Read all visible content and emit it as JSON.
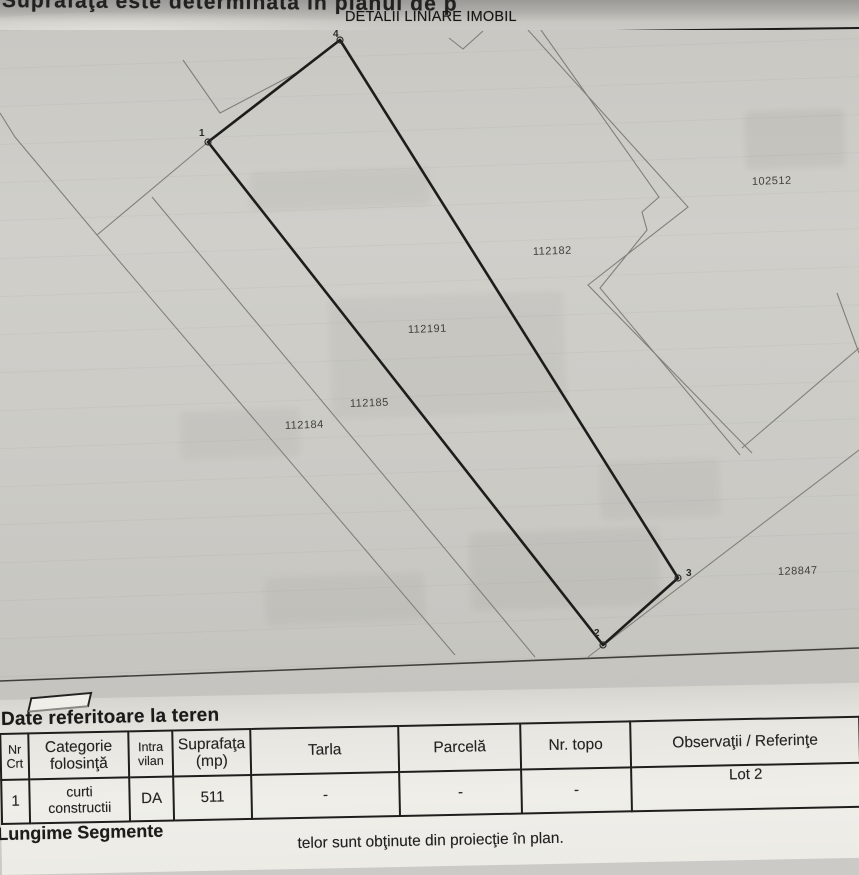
{
  "header": {
    "top_text": "Suprafaţa este determinată în planul de p",
    "band_title": "DETALII LINIARE IMOBIL"
  },
  "map": {
    "parcels": [
      "102512",
      "112182",
      "112191",
      "112185",
      "112184",
      "128847"
    ],
    "vertices": [
      "4",
      "1",
      "2",
      "3"
    ]
  },
  "table": {
    "section_title": "Date referitoare la teren",
    "columns": [
      "Nr\nCrt",
      "Categorie\nfolosinţă",
      "Intra\nvilan",
      "Suprafaţa\n(mp)",
      "Tarla",
      "Parcelă",
      "Nr. topo",
      "Observaţii / Referinţe"
    ],
    "rows": [
      [
        "1",
        "curti\nconstructii",
        "DA",
        "511",
        "-",
        "-",
        "-",
        "Lot 2"
      ]
    ]
  },
  "footer": {
    "title": "Lungime Segmente",
    "note": "telor sunt obţinute din proiecţie în plan."
  }
}
